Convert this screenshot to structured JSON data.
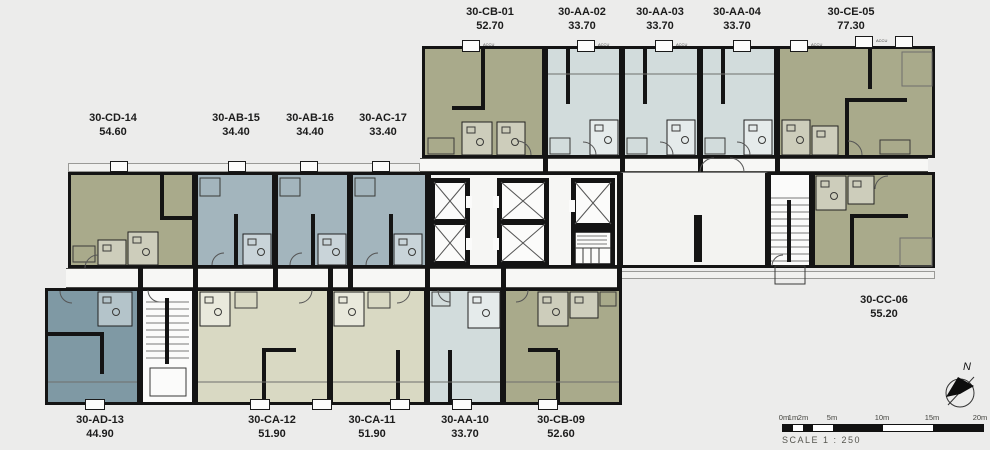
{
  "units": [
    {
      "id": "30-CB-01",
      "area": "52.70",
      "color": "#a9aa8b"
    },
    {
      "id": "30-AA-02",
      "area": "33.70",
      "color": "#d2dcdc"
    },
    {
      "id": "30-AA-03",
      "area": "33.70",
      "color": "#d2dcdc"
    },
    {
      "id": "30-AA-04",
      "area": "33.70",
      "color": "#d2dcdc"
    },
    {
      "id": "30-CE-05",
      "area": "77.30",
      "color": "#a9aa8b"
    },
    {
      "id": "30-CC-06",
      "area": "55.20",
      "color": "#a9aa8b"
    },
    {
      "id": "30-CB-09",
      "area": "52.60",
      "color": "#a9aa8b"
    },
    {
      "id": "30-AA-10",
      "area": "33.70",
      "color": "#d2dcdc"
    },
    {
      "id": "30-CA-11",
      "area": "51.90",
      "color": "#d9d9c3"
    },
    {
      "id": "30-CA-12",
      "area": "51.90",
      "color": "#d9d9c3"
    },
    {
      "id": "30-AD-13",
      "area": "44.90",
      "color": "#7f99a4"
    },
    {
      "id": "30-CD-14",
      "area": "54.60",
      "color": "#a9aa8b"
    },
    {
      "id": "30-AB-15",
      "area": "34.40",
      "color": "#a3b5bd"
    },
    {
      "id": "30-AB-16",
      "area": "34.40",
      "color": "#a3b5bd"
    },
    {
      "id": "30-AC-17",
      "area": "33.40",
      "color": "#a3b5bd"
    }
  ],
  "scale_bar": {
    "tick_labels": [
      "0m",
      "1m",
      "2m",
      "5m",
      "10m",
      "15m",
      "20m"
    ],
    "caption": "SCALE 1 : 250"
  },
  "compass": {
    "north_label": "N"
  },
  "fixture_label": "ACCU",
  "colors": {
    "background": "#ececeb",
    "wall": "#141414",
    "corridor": "#f7f7f5",
    "olive_unit": "#a9aa8b",
    "light_blue_unit": "#d2dcdc",
    "steel_blue_unit": "#a3b5bd",
    "slate_blue_unit": "#7f99a4",
    "sage_unit": "#d9d9c3"
  }
}
